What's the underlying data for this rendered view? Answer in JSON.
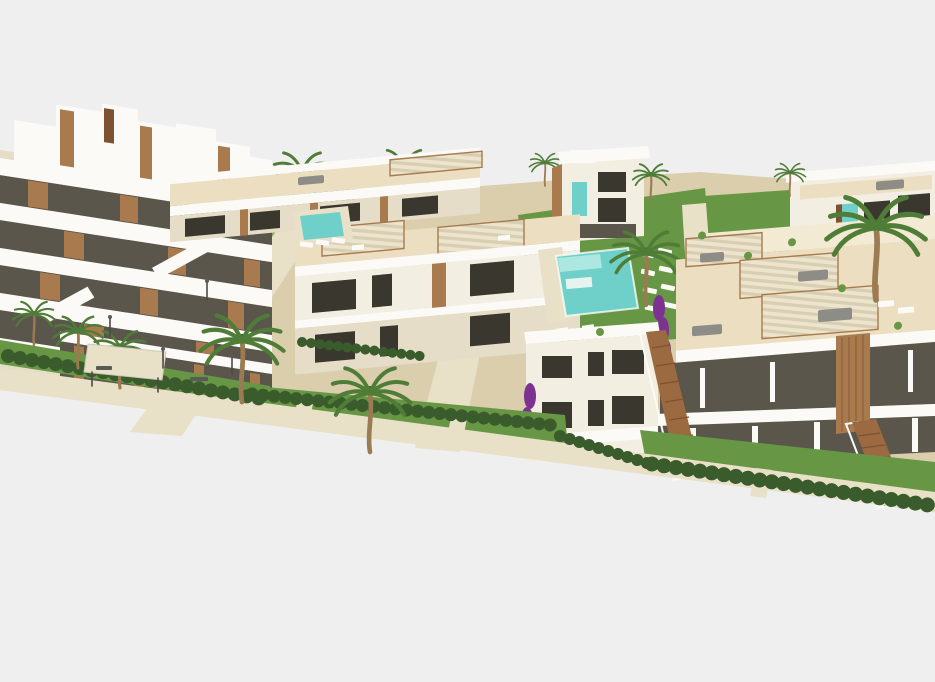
{
  "scene": {
    "type": "architectural-3d-render",
    "description": "Aerial 3D rendering of a new-build Mediterranean apartment complex: a stepped terraced apartment block on the left, rows of two-storey white apartments with cream rooftop terraces and pergolas in the centre and right, a turquoise communal swimming pool with sun loungers on a green lawn, wooden external staircases, clipped hedges, beige walkways, palm trees and purple bougainvillea, all on a plain light-grey background with a diagonal lower edge.",
    "background_color": "#efefef",
    "buildings_count": 6,
    "pools_count": 2,
    "palm_trees_count": 11
  },
  "colors": {
    "bg": "#efefef",
    "white": "#fbfaf6",
    "wall_light": "#f3eee2",
    "wall_shade": "#e6ddc8",
    "deck": "#ecdfc1",
    "deck_light": "#f3ead4",
    "glass_dark": "#3a372f",
    "glass_mid": "#5a564b",
    "wood": "#a87a4e",
    "wood_dark": "#7d5231",
    "stair_wood": "#9c6a40",
    "trunk": "#9a7b52",
    "grass": "#679644",
    "grass_light": "#7fae54",
    "hedge": "#3a5c2d",
    "pool": "#6ed0c9",
    "pool_light": "#ace8e1",
    "path": "#dbcead",
    "path_light": "#e9e0c8",
    "canopy_a": "#ece4cd",
    "canopy_b": "#d8ceb2",
    "furniture": "#8e8c86",
    "furniture_dark": "#5b5b55",
    "purple": "#7d3190",
    "palm": "#4f7d38",
    "palm_dark": "#3c6329",
    "lamp": "#4a4a46"
  }
}
